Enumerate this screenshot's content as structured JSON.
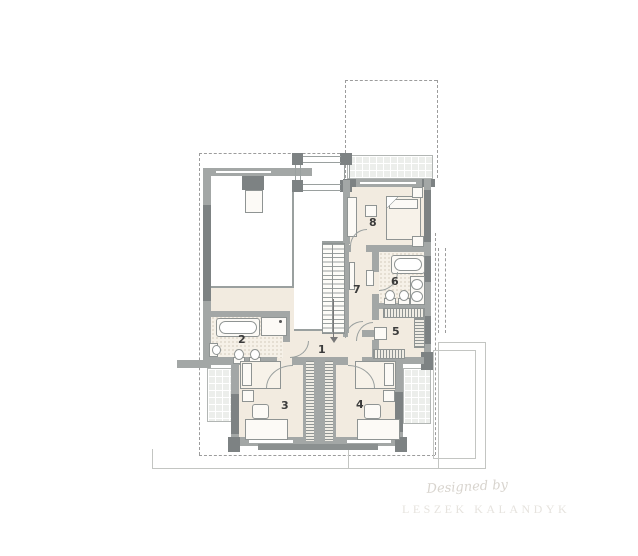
{
  "rooms": [
    {
      "number": "1"
    },
    {
      "number": "2"
    },
    {
      "number": "3"
    },
    {
      "number": "4"
    },
    {
      "number": "5"
    },
    {
      "number": "6"
    },
    {
      "number": "7"
    },
    {
      "number": "8"
    }
  ],
  "watermark": {
    "designed_by": "Designed by",
    "designer_name": "LESZEK KALANDYK"
  },
  "colors": {
    "wall": "#a3a7a6",
    "wall_window": "#7d8283",
    "floor": "#f2ebe0",
    "bathroom_floor": "#f6f1e8",
    "balcony_tile": "#eceeeb",
    "line_gray": "#9aa09f",
    "dashed_outline": "#9c9c9c",
    "label_text": "#3b3b3b",
    "watermark_script": "#d8d4ce",
    "watermark_name": "#e6e3de"
  }
}
